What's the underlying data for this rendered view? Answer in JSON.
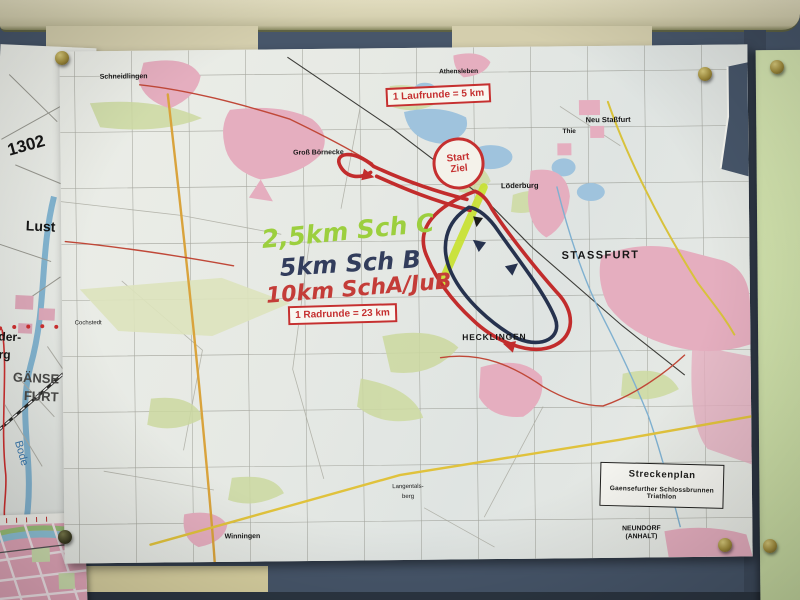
{
  "colors": {
    "board_slate": "#47566a",
    "board_slate_dark": "#3e4b5d",
    "beam_cream": "#d6d1b1",
    "panel_cream": "#d4cead",
    "panel_beige": "#d9d1a1",
    "green_paper": "#cfe0a8",
    "paper_white": "#e8eae5",
    "course_red": "#c22c2c",
    "course_blue": "#26324e",
    "course_highlight": "#c8e22e",
    "annotation_box_red": "#c53030",
    "map_town_pink": "#e5aebf",
    "map_field_green": "#ccd9a0",
    "map_lake_blue": "#9fc3dd",
    "pin_brass": "#a08c3c"
  },
  "main_map": {
    "boxes": {
      "laufrunde": "1 Laufrunde = 5 km",
      "radrunde": "1 Radrunde = 23 km"
    },
    "start": {
      "line1": "Start",
      "line2": "Ziel"
    },
    "handwriting": [
      {
        "text": "2,5km Sch C",
        "color": "#9ccf3e",
        "x": 200,
        "y": 170,
        "size": 25,
        "rot": -5
      },
      {
        "text": "5km Sch B",
        "color": "#323d5c",
        "x": 218,
        "y": 203,
        "size": 24,
        "rot": -3
      },
      {
        "text": "10km SchA/JuB",
        "color": "#c43c38",
        "x": 204,
        "y": 230,
        "size": 22,
        "rot": -4
      }
    ],
    "legend": {
      "title": "Streckenplan",
      "line1": "Gaensefurther Schlossbrunnen",
      "line2": "Triathlon"
    },
    "places": [
      {
        "label": "Schneidlingen",
        "x": 64,
        "y": 26,
        "size": 7,
        "bold": true
      },
      {
        "label": "Athensleben",
        "x": 399,
        "y": 25,
        "size": 6.5,
        "bold": true
      },
      {
        "label": "Groß Börnecke",
        "x": 258,
        "y": 104,
        "size": 7,
        "bold": true
      },
      {
        "label": "Löderburg",
        "x": 459,
        "y": 139,
        "size": 7.5,
        "bold": true
      },
      {
        "label": "Thie",
        "x": 509,
        "y": 86,
        "size": 6.5,
        "bold": true
      },
      {
        "label": "Neu Staßfurt",
        "x": 548,
        "y": 74,
        "size": 7.5,
        "bold": true
      },
      {
        "label": "STASSFURT",
        "x": 539,
        "y": 210,
        "size": 11,
        "bold": true,
        "spacing": 1.4
      },
      {
        "label": "HECKLINGEN",
        "x": 432,
        "y": 290,
        "size": 8.5,
        "bold": true,
        "spacing": 0.8
      },
      {
        "label": "Winningen",
        "x": 178,
        "y": 487,
        "size": 7,
        "bold": true
      },
      {
        "label": "Cochstedt",
        "x": 26,
        "y": 272,
        "size": 6
      },
      {
        "label": "Langentals-",
        "x": 344,
        "y": 439,
        "size": 6
      },
      {
        "label": "berg",
        "x": 344,
        "y": 449,
        "size": 6
      },
      {
        "label": "NEUNDORF",
        "x": 577,
        "y": 484,
        "size": 6.8,
        "bold": true
      },
      {
        "label": "(ANHALT)",
        "x": 577,
        "y": 492,
        "size": 6.8,
        "bold": true
      }
    ]
  },
  "left_map": {
    "labels": [
      {
        "label": "1302",
        "x": 30,
        "y": 100,
        "size": 17,
        "bold": true,
        "rot": -18
      },
      {
        "label": "Lust",
        "x": 48,
        "y": 180,
        "size": 14,
        "bold": true
      },
      {
        "label": "der-",
        "x": 22,
        "y": 292,
        "size": 12,
        "bold": true
      },
      {
        "label": "urg",
        "x": 14,
        "y": 310,
        "size": 12,
        "bold": true
      },
      {
        "label": "GÄNSE",
        "x": 50,
        "y": 332,
        "size": 13,
        "bold": true,
        "color": "#4a4a48"
      },
      {
        "label": "FURT",
        "x": 56,
        "y": 350,
        "size": 13,
        "bold": true,
        "color": "#4a4a48"
      },
      {
        "label": "Bode",
        "x": 38,
        "y": 408,
        "size": 11,
        "bold": false,
        "color": "#3a7ab0",
        "rot": 72
      }
    ]
  }
}
